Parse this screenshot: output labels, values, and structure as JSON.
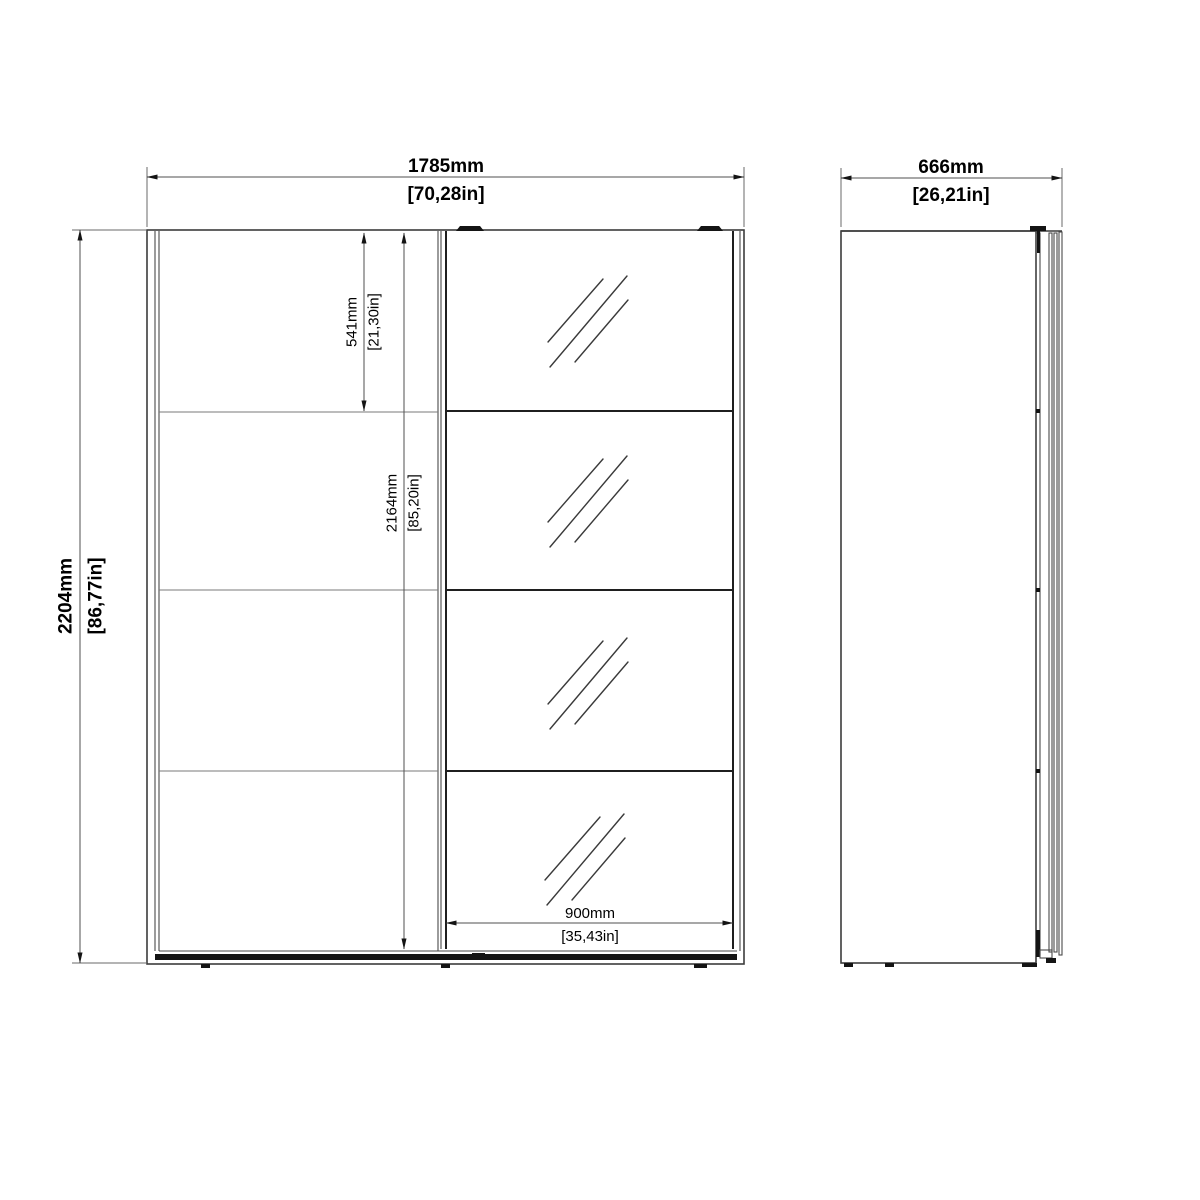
{
  "front_view": {
    "overall_width": {
      "mm": "1785mm",
      "inches": "[70,28in]"
    },
    "overall_height": {
      "mm": "2204mm",
      "inches": "[86,77in]"
    },
    "top_panel_height": {
      "mm": "541mm",
      "inches": "[21,30in]"
    },
    "door_height": {
      "mm": "2164mm",
      "inches": "[85,20in]"
    },
    "mirror_door_width": {
      "mm": "900mm",
      "inches": "[35,43in]"
    }
  },
  "side_view": {
    "overall_depth": {
      "mm": "666mm",
      "inches": "[26,21in]"
    }
  },
  "colors": {
    "background": "#ffffff",
    "line": "#3c3c3c",
    "divider": "#7a7a7a",
    "text": "#000000",
    "hardware": "#141414"
  }
}
